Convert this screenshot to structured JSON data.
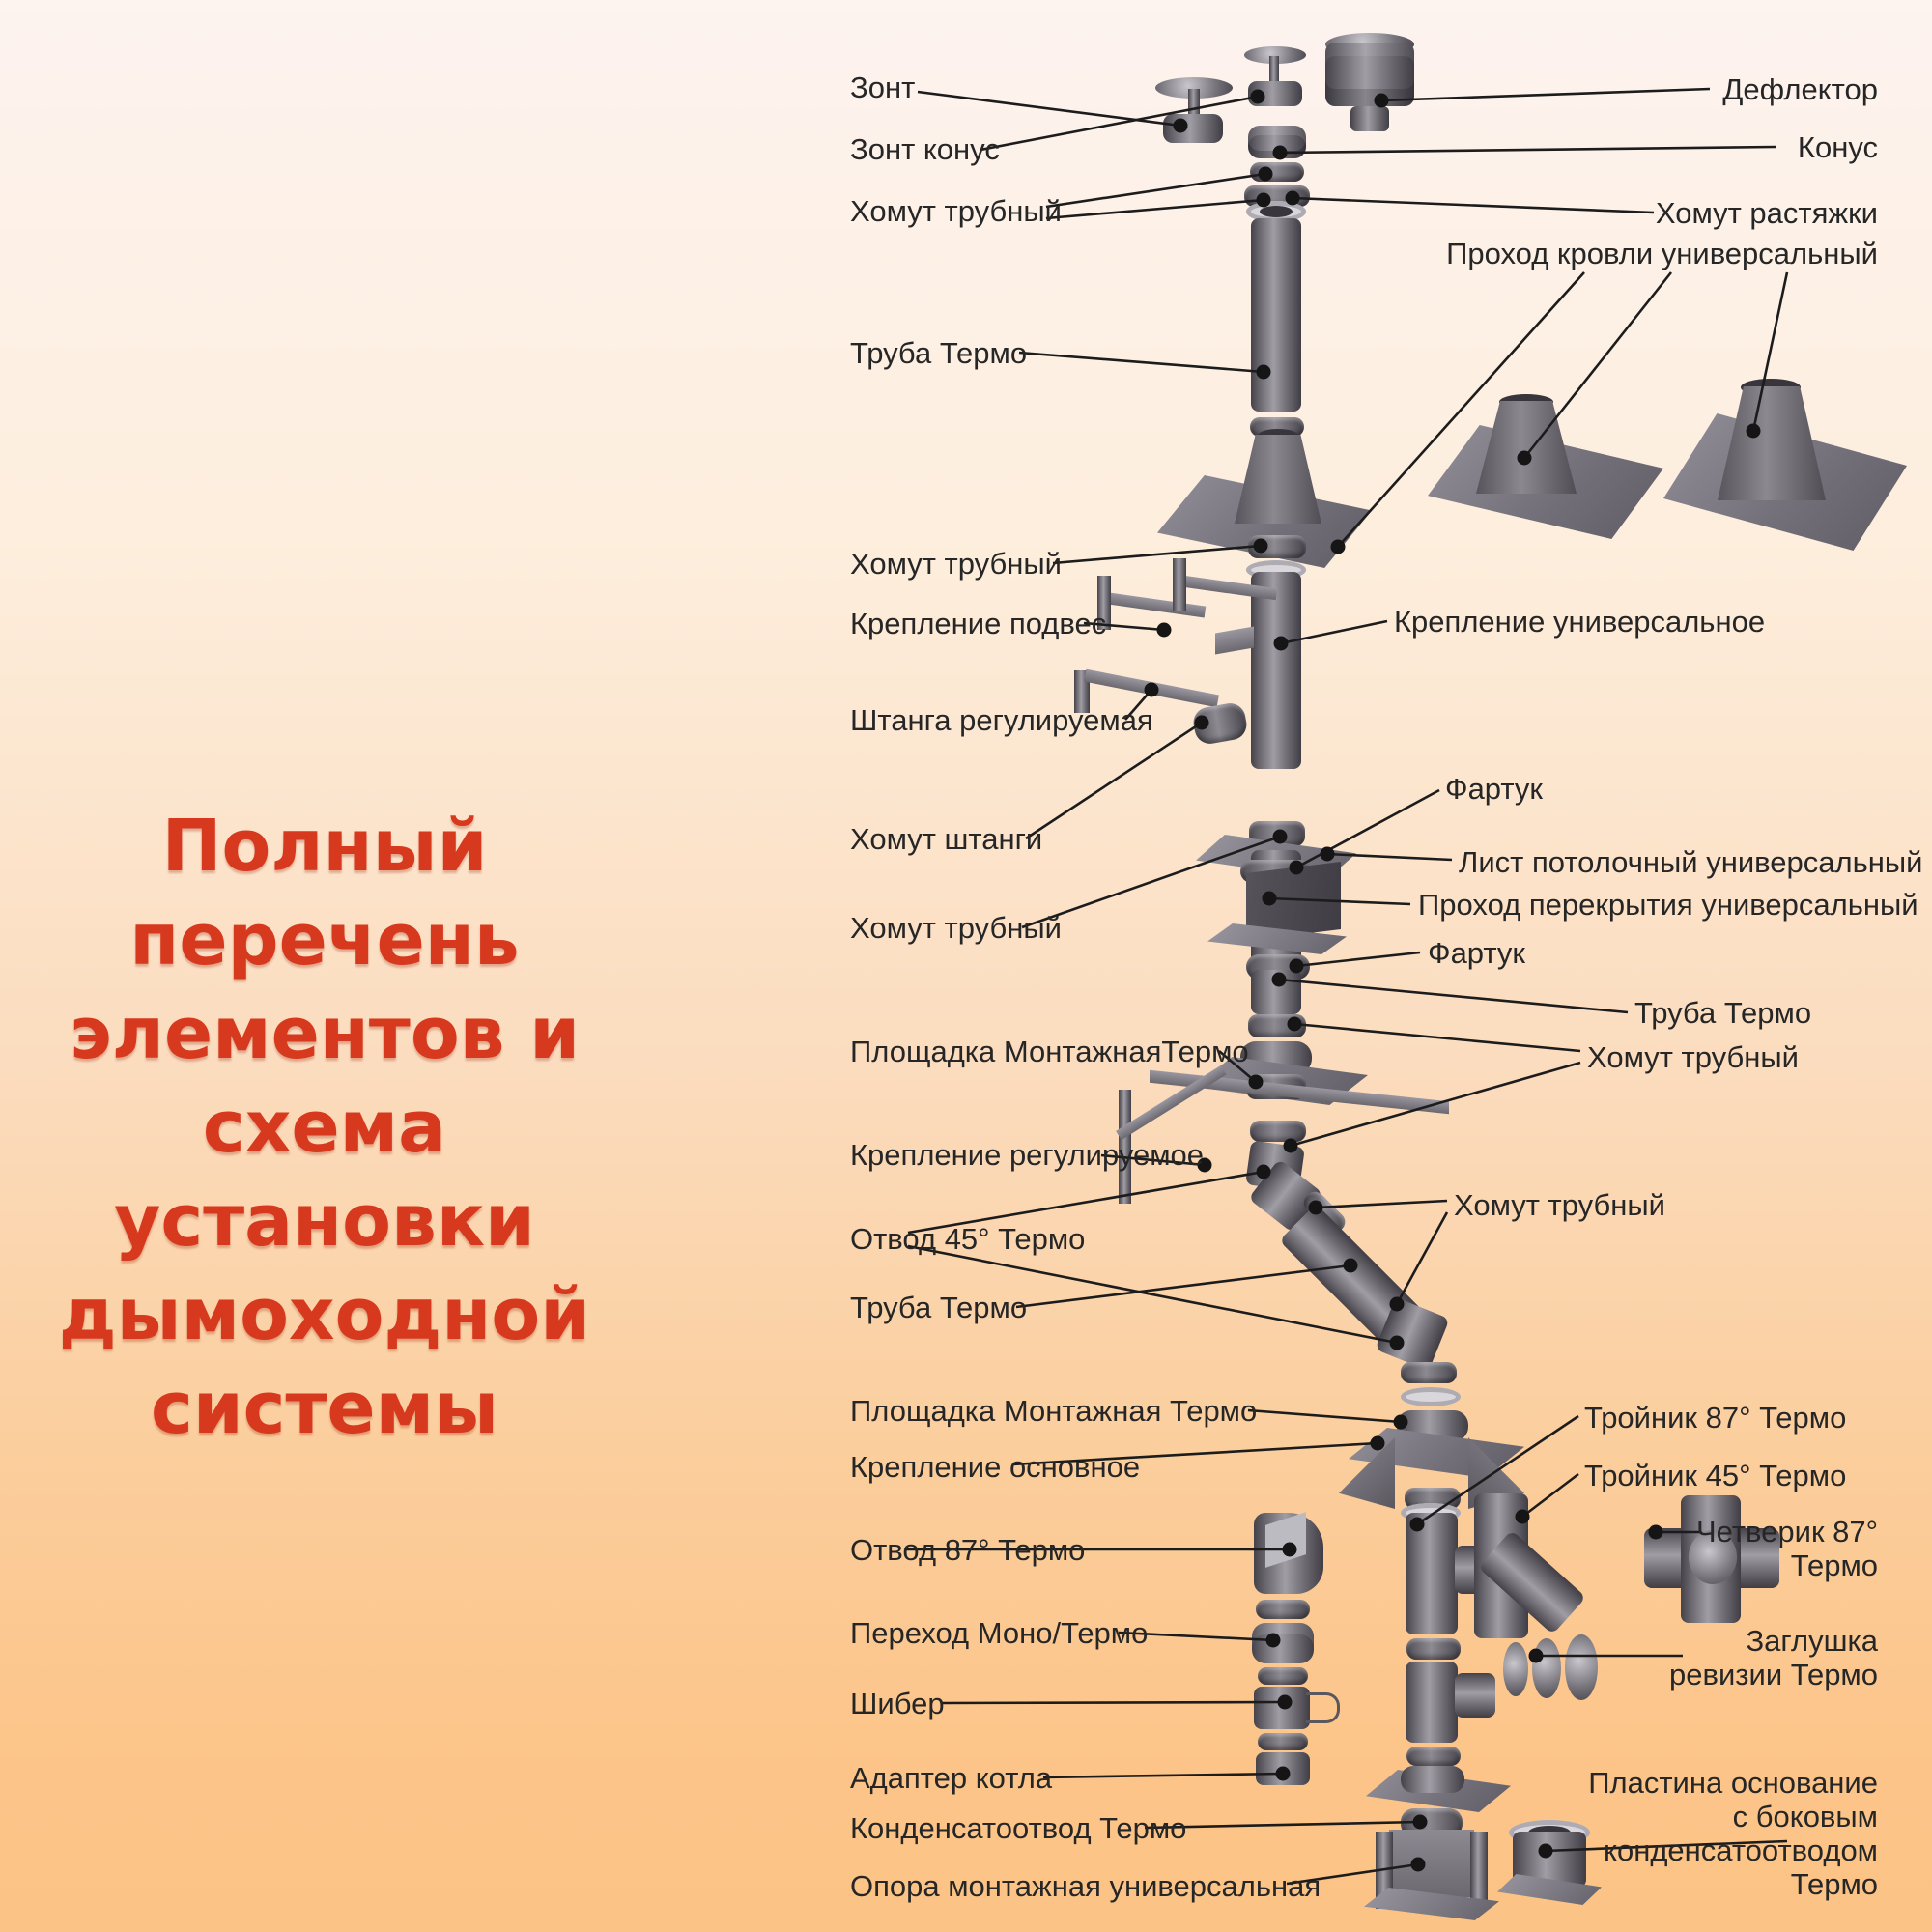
{
  "title": {
    "lines": [
      "Полный перечень",
      "элементов и схема",
      "установки",
      "дымоходной",
      "системы"
    ],
    "color": "#d6391d"
  },
  "labels_left": {
    "zont": "Зонт",
    "zont_konus": "Зонт конус",
    "homut_trubny_top": "Хомут трубный",
    "truba_termo_1": "Труба Термо",
    "homut_trubny_2": "Хомут трубный",
    "kreplenie_podves": "Крепление подвес",
    "shtanga": "Штанга регулируемая",
    "homut_shtangi": "Хомут штанги",
    "homut_trubny_3": "Хомут трубный",
    "ploshchadka_1": "Площадка МонтажнаяТермо",
    "kreplenie_reg": "Крепление регулируемое",
    "otvod_45": "Отвод 45° Термо",
    "truba_termo_2": "Труба Термо",
    "ploshchadka_2": "Площадка Монтажная Термо",
    "kreplenie_osn": "Крепление основное",
    "otvod_87": "Отвод 87° Термо",
    "perekhod": "Переход Моно/Термо",
    "shiber": "Шибер",
    "adapter": "Адаптер котла",
    "kondensatootvod": "Конденсатоотвод Термо",
    "opora": "Опора монтажная универсальная"
  },
  "labels_right": {
    "deflektor": "Дефлектор",
    "konus": "Конус",
    "homut_rastyazhki": "Хомут растяжки",
    "prohod_krovli": "Проход кровли универсальный",
    "kreplenie_univ": "Крепление универсальное",
    "fartuk_1": "Фартук",
    "list_potolochny": "Лист потолочный универсальный",
    "prohod_perekrytiya": "Проход перекрытия универсальный",
    "fartuk_2": "Фартук",
    "truba_termo": "Труба Термо",
    "homut_trubny_a": "Хомут трубный",
    "homut_trubny_b": "Хомут трубный",
    "troynik_87": "Тройник 87° Термо",
    "troynik_45": "Тройник 45° Термо",
    "chetverik_line1": "Четверик 87°",
    "chetverik_line2": "Термо",
    "zaglushka_line1": "Заглушка",
    "zaglushka_line2": "ревизии Термо",
    "plastina_line1": "Пластина основание",
    "plastina_line2": "с боковым",
    "plastina_line3": "конденсатоотводом",
    "plastina_line4": "Термо"
  }
}
